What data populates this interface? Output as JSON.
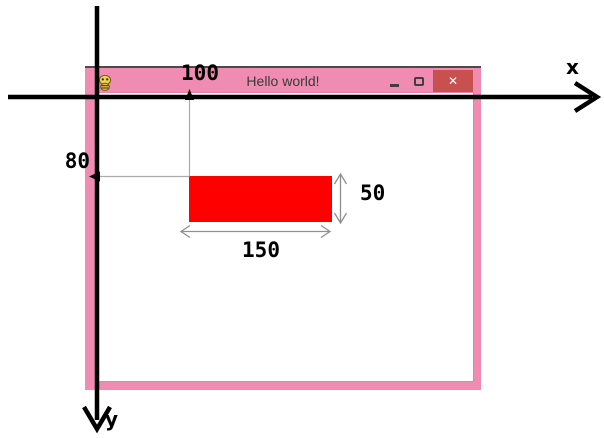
{
  "axes": {
    "x_label": "x",
    "y_label": "y"
  },
  "window": {
    "title": "Hello world!",
    "icon": "app-icon",
    "close_glyph": "✕"
  },
  "annotations": {
    "x_position": "100",
    "y_position": "80",
    "rect_width": "150",
    "rect_height": "50"
  },
  "colors": {
    "window_pink": "#f08cb2",
    "titlebar_outline": "#4a4a4a",
    "close_button_red": "#c8504e",
    "rectangle_red": "#ff0000",
    "axis_black": "#000000",
    "guide_gray": "#ababab",
    "dimension_gray": "#8f8f8f"
  }
}
